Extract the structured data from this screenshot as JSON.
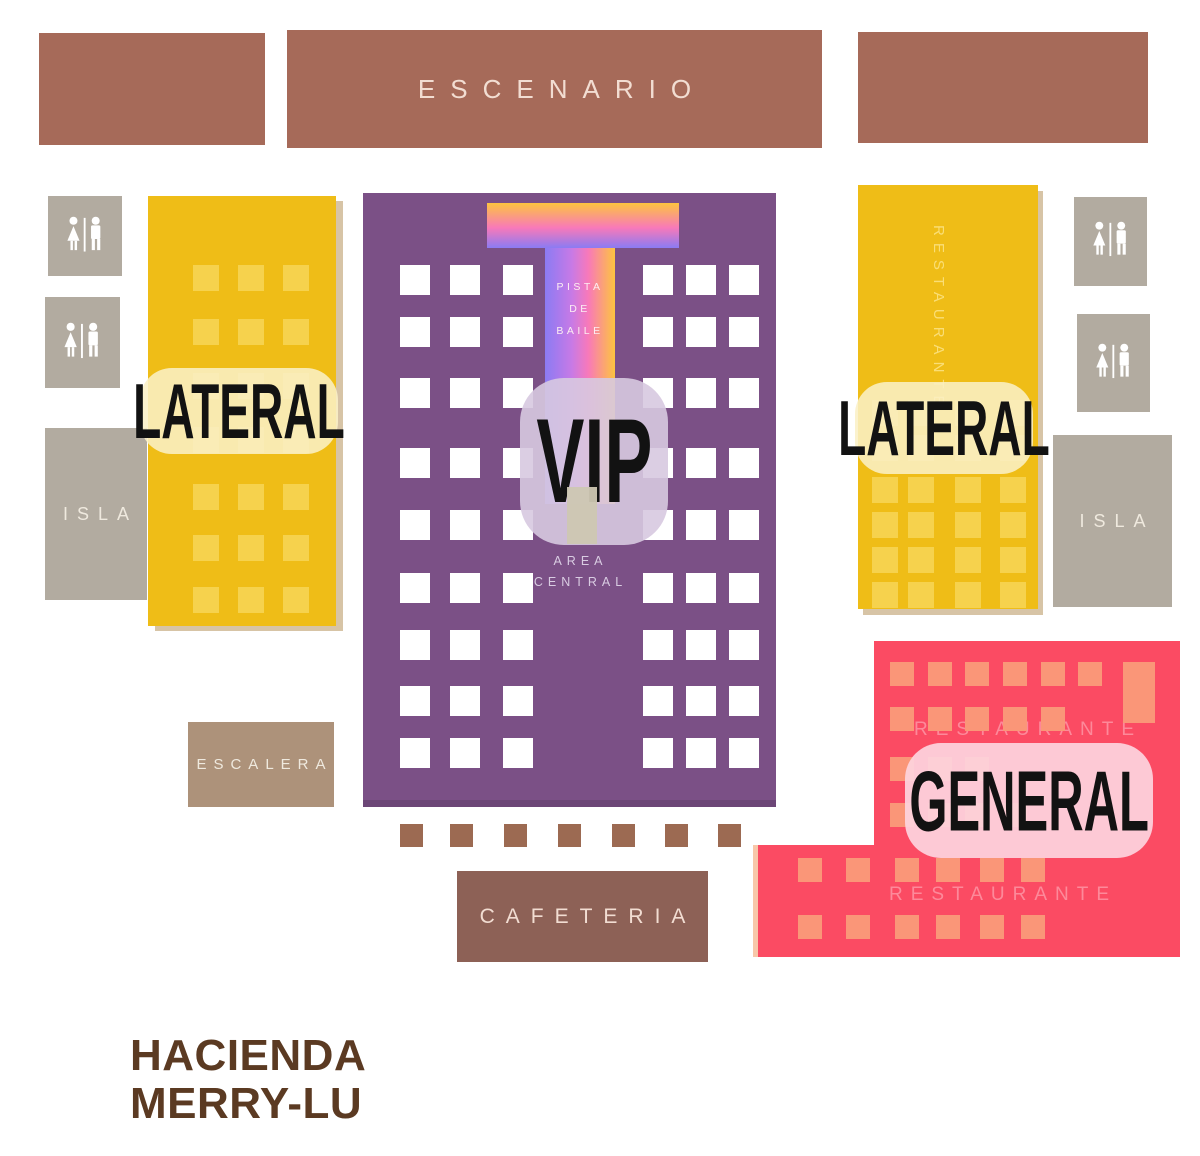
{
  "colors": {
    "stage-brown": "#a66a59",
    "stage-text": "#f2ddd2",
    "yellow": "#efbd17",
    "yellow-seat": "#f6d24d",
    "yellow-shadow": "rgba(151,99,21,0.38)",
    "yellow-label-bg": "rgba(250,240,198,0.87)",
    "yellow-watermark": "rgba(255,236,160,0.7)",
    "purple": "#7b5086",
    "purple-edge": "#6c4677",
    "white-seat": "#ffffff",
    "lavender-label-bg": "rgba(215,201,224,0.9)",
    "area-text": "#d9cce2",
    "walkway-beige": "rgba(205,199,178,0.95)",
    "dance-text": "#fdeef2",
    "grad-yellow": "#fdc43f",
    "grad-pink": "#f879b9",
    "grad-violet": "#8b7bf3",
    "pink": "#fb4b63",
    "pink-edge": "#f8c7a9",
    "salmon-seat": "#fa9678",
    "pink-label-bg": "rgba(253,211,222,0.93)",
    "pink-watermark": "rgba(255,190,200,0.55)",
    "gray-block": "#b2aba0",
    "gray-text": "#efe9de",
    "escalera-tan": "#ad927a",
    "cafeteria-brown": "#8d6156",
    "dot-brown": "#9c6a52",
    "label-text": "#121212",
    "logo-brown": "#5b3a22"
  },
  "stage": {
    "label": "ESCENARIO"
  },
  "laterals": {
    "left_label": "LATERAL",
    "right_label": "LATERAL",
    "right_watermark": "RESTAURANTE"
  },
  "vip": {
    "label": "VIP",
    "dance_line1": "PISTA",
    "dance_line2": "DE",
    "dance_line3": "BAILE",
    "area_line1": "AREA",
    "area_line2": "CENTRAL"
  },
  "general": {
    "label": "GENERAL",
    "watermark_top": "RESTAURANTE",
    "watermark_bottom": "RESTAURANTE"
  },
  "facilities": {
    "isla_left": "ISLA",
    "isla_right": "ISLA",
    "escalera": "ESCALERA",
    "cafeteria": "CAFETERIA"
  },
  "brand": {
    "line1": "HACIENDA",
    "line2": "MERRY-LU"
  },
  "seats": {
    "vip-seats": {
      "size": 30,
      "cols": [
        37,
        87,
        140,
        280,
        323,
        366
      ],
      "rows": [
        72,
        124,
        185,
        255,
        317,
        380,
        437,
        493,
        545
      ]
    },
    "lateral-left-seats": {
      "size": 26,
      "cols": [
        45,
        90,
        135
      ],
      "rows": [
        69,
        123,
        177,
        231,
        288,
        339,
        391
      ]
    },
    "lateral-right-seats": {
      "size": 26,
      "cols": [
        14,
        50,
        97,
        142
      ],
      "rows": [
        215,
        250,
        292,
        327,
        362,
        397
      ]
    },
    "general-seats": {
      "size": 24,
      "items": [
        [
          137,
          21
        ],
        [
          175,
          21
        ],
        [
          212,
          21
        ],
        [
          250,
          21
        ],
        [
          288,
          21
        ],
        [
          325,
          21
        ],
        [
          137,
          66
        ],
        [
          175,
          66
        ],
        [
          212,
          66
        ],
        [
          250,
          66
        ],
        [
          288,
          66
        ],
        [
          137,
          116
        ],
        [
          175,
          116
        ],
        [
          212,
          116
        ],
        [
          137,
          162
        ],
        [
          175,
          162
        ],
        [
          212,
          162
        ],
        [
          250,
          162
        ],
        [
          45,
          217
        ],
        [
          93,
          217
        ],
        [
          142,
          217
        ],
        [
          183,
          217
        ],
        [
          227,
          217
        ],
        [
          268,
          217
        ],
        [
          45,
          274
        ],
        [
          93,
          274
        ],
        [
          142,
          274
        ],
        [
          183,
          274
        ],
        [
          227,
          274
        ],
        [
          268,
          274
        ]
      ],
      "extra": [
        [
          370,
          21,
          32,
          61
        ]
      ]
    },
    "aisle-dots": {
      "size": 23,
      "items": [
        [
          0,
          0
        ],
        [
          50,
          0
        ],
        [
          104,
          0
        ],
        [
          158,
          0
        ],
        [
          212,
          0
        ],
        [
          265,
          0
        ],
        [
          318,
          0
        ]
      ]
    }
  }
}
